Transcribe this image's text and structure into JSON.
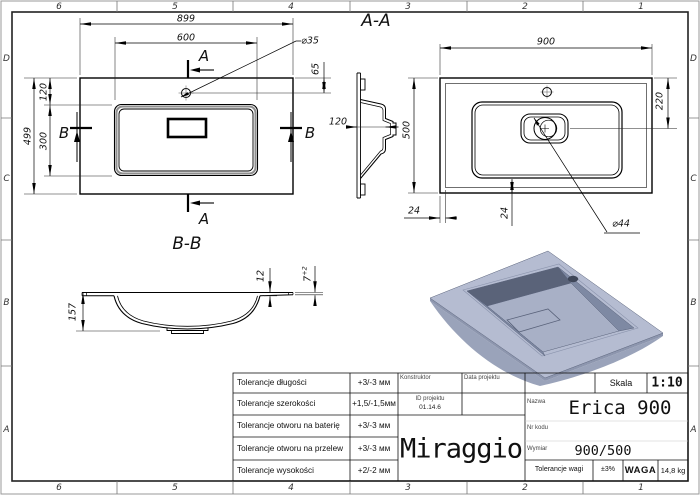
{
  "drawing": {
    "zones": {
      "columns": [
        "6",
        "5",
        "4",
        "3",
        "2",
        "1"
      ],
      "rows": [
        "D",
        "C",
        "B",
        "A"
      ]
    },
    "plan_view": {
      "section_a": "A",
      "section_b": "B",
      "dim_overall_width": "899",
      "dim_basin_width": "600",
      "dim_faucet_hole": "⌀35",
      "dim_faucet_offset": "65",
      "dim_overall_depth": "499",
      "dim_basin_top_offset": "120",
      "dim_basin_depth": "300",
      "dim_bowl_depth": "120"
    },
    "section_aa": {
      "title": "A-A",
      "dim_width": "900",
      "dim_depth": "500",
      "dim_drain_offset": "220",
      "dim_side_margin": "24",
      "dim_bottom_margin": "24",
      "dim_drain_hole": "⌀44"
    },
    "section_bb": {
      "title": "B-B",
      "dim_total_height": "157",
      "dim_rim_thickness": "12",
      "dim_edge_thickness": "7",
      "dim_edge_tolerance": "+2"
    }
  },
  "title_block": {
    "tolerances": [
      {
        "label": "Tolerancje długości",
        "value": "+3/-3 мм"
      },
      {
        "label": "Tolerancje szerokości",
        "value": "+1,5/-1,5мм"
      },
      {
        "label": "Tolerancje otworu na baterię",
        "value": "+3/-3 мм"
      },
      {
        "label": "Tolerancje otworu na przelew",
        "value": "+3/-3 мм"
      },
      {
        "label": "Tolerancje wysokości",
        "value": "+2/-2 мм"
      }
    ],
    "konstruktor_label": "Konstruktor",
    "data_projektu_label": "Data projektu",
    "id_projektu_label": "ID projektu",
    "id_projektu_value": "01.14.6",
    "brand": "Miraggio",
    "skala_label": "Skala",
    "skala_value": "1:10",
    "nazwa_label": "Nazwa",
    "nazwa_value": "Erica 900",
    "nr_kodu_label": "Nr kodu",
    "wymiar_label": "Wymiar",
    "wymiar_value": "900/500",
    "tolerancje_wagi_label": "Tolerancje wagi",
    "tolerancje_wagi_value": "±3%",
    "waga_label": "WAGA",
    "waga_value": "14,8 kg"
  },
  "colors": {
    "line": "#000000",
    "render_top": "#b5bcd1",
    "render_skirt": "#9aa3ba",
    "render_side": "#8d96ae",
    "render_inner_dark": "#5a6379",
    "render_inner_mid": "#7e89a3",
    "render_inner_bottom": "#a8b0c6",
    "render_hole": "#3f4759"
  }
}
